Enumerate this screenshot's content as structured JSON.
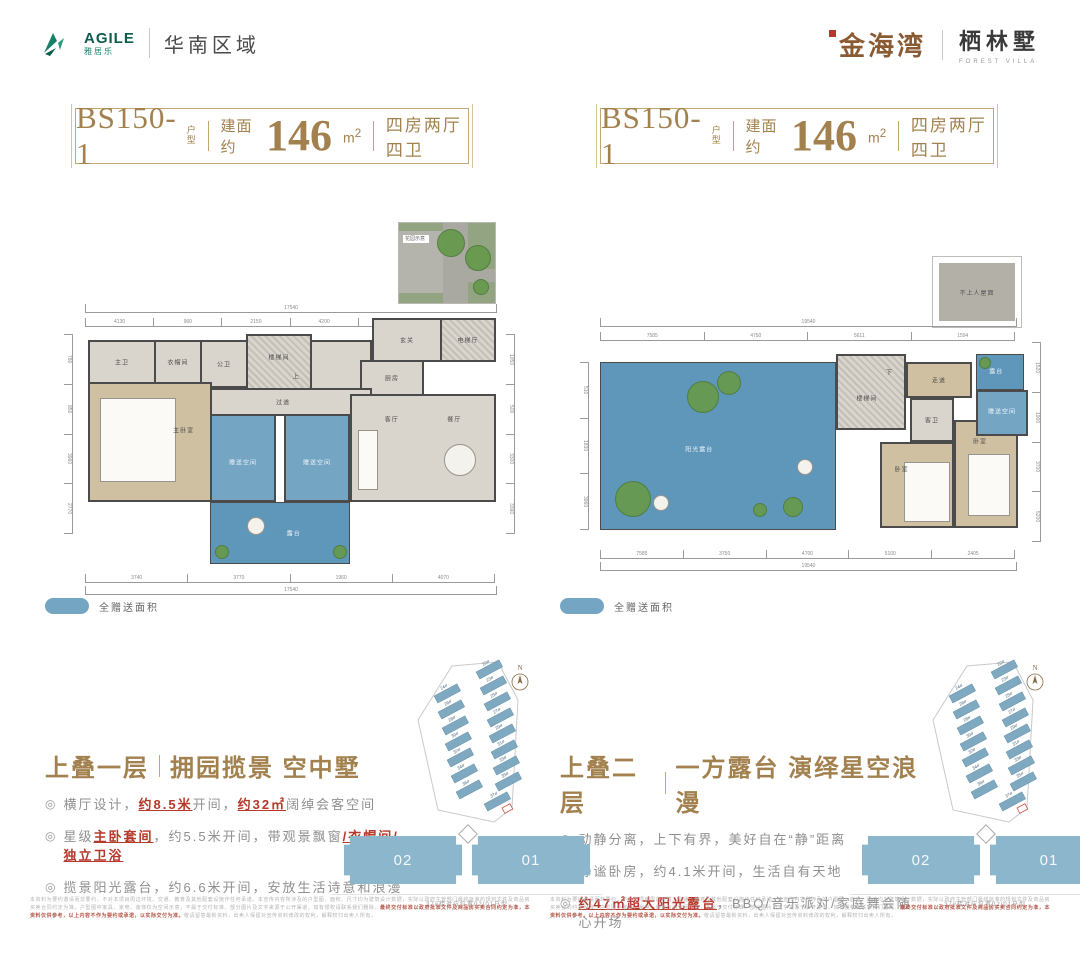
{
  "header": {
    "brand_en": "AGILE",
    "brand_cn": "雅居乐",
    "region": "华南区域",
    "logo_gold": "金海湾",
    "logo_dark": "栖林墅",
    "logo_dark_en": "FOREST VILLA"
  },
  "panel_left": {
    "title": {
      "code": "BS150-1",
      "code_tag": "户型",
      "area_prefix": "建面约",
      "area": "146",
      "area_unit_base": "m",
      "area_unit_sup": "2",
      "layout": "四房两厅四卫"
    },
    "legend": "全赠送面积",
    "marker": "◎",
    "section": {
      "t1": "上叠一层",
      "t2": "拥园揽景 空中墅",
      "bullets": [
        [
          {
            "t": "横厅设计，"
          },
          {
            "t": "约8.5米",
            "em": true
          },
          {
            "t": "开间，"
          },
          {
            "t": "约32㎡",
            "em": true
          },
          {
            "t": "阔绰会客空间"
          }
        ],
        [
          {
            "t": "星级"
          },
          {
            "t": "主卧套间",
            "em": true
          },
          {
            "t": "，约5.5米开间，带观景飘窗"
          },
          {
            "t": "/衣帽间/独立卫浴",
            "em": true
          }
        ],
        [
          {
            "t": "揽景阳光露台，约6.6米开间，安放生活诗意和浪漫"
          }
        ]
      ]
    },
    "footprint": {
      "unit_02": "02",
      "unit_01": "01",
      "caption": "37#楼对应位置02/01户型"
    }
  },
  "panel_right": {
    "title": {
      "code": "BS150-1",
      "code_tag": "户型",
      "area_prefix": "建面约",
      "area": "146",
      "area_unit_base": "m",
      "area_unit_sup": "2",
      "layout": "四房两厅四卫"
    },
    "legend": "全赠送面积",
    "marker": "◎",
    "section": {
      "t1": "上叠二层",
      "t2": "一方露台 演绎星空浪漫",
      "bullets": [
        [
          {
            "t": "动静分离，上下有界，美好自在“静”距离"
          }
        ],
        [
          {
            "t": "静谧卧房，约4.1米开间，生活自有天地"
          }
        ],
        [
          {
            "t": "约47㎡超大阳光露台",
            "em": true
          },
          {
            "t": "，BBQ/音乐派对/家庭舞会随心开场"
          }
        ]
      ]
    },
    "footprint": {
      "unit_02": "02",
      "unit_01": "01",
      "caption": "37#楼对应位置02/01户型"
    }
  },
  "plan1": {
    "garden_label": "花园示意",
    "rooms": {
      "master_bath": "主卫",
      "closet": "衣帽间",
      "guest_bath": "公卫",
      "stair": "楼梯间",
      "up": "上",
      "foyer": "玄关",
      "elevator": "电梯厅",
      "kitchen": "厨房",
      "corridor": "过道",
      "living": "客厅",
      "dining": "餐厅",
      "master_bed": "主卧室",
      "gift_a": "赠送空间",
      "gift_b": "赠送空间",
      "terrace": "露台"
    },
    "dims": {
      "top_total": "17540",
      "top": [
        "4130",
        "960",
        "2150",
        "4200",
        "3600",
        "1500"
      ],
      "bottom": [
        "3740",
        "3770",
        "1960",
        "4070"
      ],
      "bottom_total": "17540",
      "left": [
        "780",
        "850",
        "3960",
        "2770"
      ],
      "right": [
        "1050",
        "500",
        "3300",
        "3390"
      ]
    }
  },
  "plan2": {
    "roof_label": "不上人屋面",
    "rooms": {
      "sun_terrace": "阳光露台",
      "stair": "楼梯间",
      "down": "下",
      "hall": "走道",
      "guest_bath": "客卫",
      "bed_a": "卧室",
      "bed_b": "卧室",
      "gift": "赠送空间",
      "balcony": "露台"
    },
    "dims": {
      "top_total": "19540",
      "top": [
        "7585",
        "4750",
        "5611",
        "1594"
      ],
      "bottom": [
        "7585",
        "3750",
        "4700",
        "5100",
        "2405"
      ],
      "bottom_total": "19540",
      "left": [
        "510",
        "1830",
        "3960"
      ],
      "right": [
        "1520",
        "1900",
        "3700",
        "5200"
      ]
    }
  },
  "sitemap": {
    "north": "N",
    "buildings": [
      "22#",
      "23#",
      "24#",
      "25#",
      "26#",
      "27#",
      "28#",
      "29#",
      "30#",
      "31#",
      "32#",
      "33#",
      "34#",
      "35#",
      "36#",
      "37#"
    ]
  },
  "disclaimer": {
    "left": [
      {
        "t": "本资料为要约邀请而非要约，不对本项目周边环境、交通、教育及其他配套设施作任何承诺。本宣传内容所涉及的户型图、面积、尺寸均为建筑设计数据，实际以政府主管部门最终批准的规划文件及商品房买卖合同约定为准。户型图中家具、家电、装饰仅为空间示意，不属于交付标准。部分图片及文字来源于公开渠道，如有侵权请联系我们删除。"
      },
      {
        "t": "最终交付标准以政府批准文件及商品房买卖合同约定为准，本资料仅供参考，以上内容不作为要约或承诺，以实际交付为准。",
        "em": true
      },
      {
        "t": "敬请留意最新资料，出卖人保留对宣传资料修改的权利，解释权归出卖人所有。"
      }
    ],
    "right": [
      {
        "t": "本资料为要约邀请而非要约，不对本项目周边环境、交通、教育及其他配套设施作任何承诺。本宣传内容所涉及的户型图、面积、尺寸均为建筑设计数据，实际以政府主管部门最终批准的规划文件及商品房买卖合同约定为准。户型图中家具、家电、装饰仅为空间示意，不属于交付标准。部分图片及文字来源于公开渠道，如有侵权请联系我们删除。"
      },
      {
        "t": "最终交付标准以政府批准文件及商品房买卖合同约定为准，本资料仅供参考，以上内容不作为要约或承诺，以实际交付为准。",
        "em": true
      },
      {
        "t": "敬请留意最新资料，出卖人保留对宣传资料修改的权利，解释权归出卖人所有。"
      }
    ]
  }
}
